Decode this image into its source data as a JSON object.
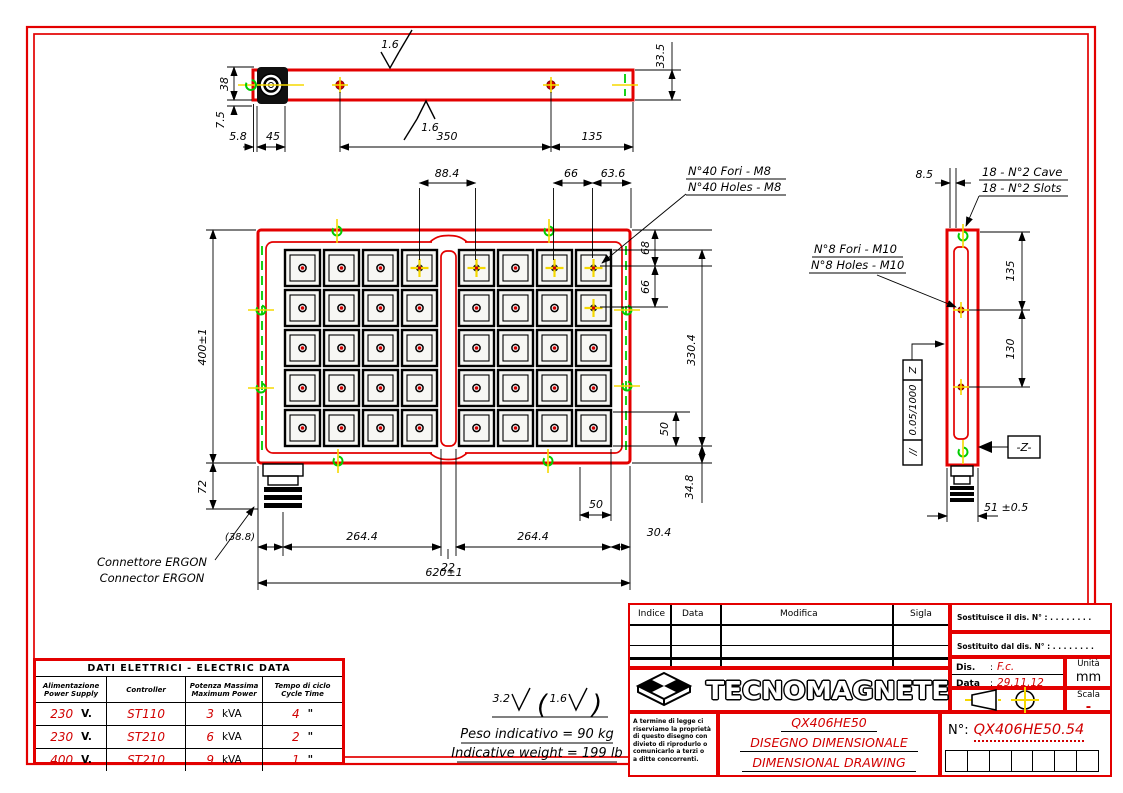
{
  "colors": {
    "line_red": "#e30000",
    "value_red": "#d10000",
    "slot_green": "#00cc00",
    "hole_yellow": "#f5d800"
  },
  "drawing": {
    "top_view": {
      "f_top": "1.6",
      "f_bot": "1.6",
      "d335": "33.5",
      "d38": "38",
      "d75": "7.5",
      "d58": "5.8",
      "d45": "45",
      "d350": "350",
      "d135": "135"
    },
    "front_view": {
      "d884": "88.4",
      "d66t": "66",
      "d636": "63.6",
      "m8_it": "N°40 Fori - M8",
      "m8_en": "N°40 Holes - M8",
      "d68": "68",
      "d66r": "66",
      "d3304": "330.4",
      "d50r": "50",
      "d348": "34.8",
      "d50b": "50",
      "d400": "400±1",
      "d72": "72",
      "d388": "(38.8)",
      "d2644a": "264.4",
      "d22": "22",
      "d2644b": "264.4",
      "d304": "30.4",
      "d620": "620±1",
      "conn_it": "Connettore ERGON",
      "conn_en": "Connector ERGON"
    },
    "side_view": {
      "d85": "8.5",
      "cave_it": "18 - N°2 Cave",
      "cave_en": "18 - N°2 Slots",
      "m10_it": "N°8 Fori - M10",
      "m10_en": "N°8 Holes - M10",
      "d135": "135",
      "d130": "130",
      "fcf_sym": "//",
      "fcf_val": "0.05/1000",
      "fcf_z": "Z",
      "zbox": "-Z-",
      "d51": "51 ±0.5"
    },
    "notes": {
      "ra": "3.2",
      "rb": "1.6",
      "w_it": "Peso indicativo = 90 kg",
      "w_en": "Indicative weight = 199 lb"
    }
  },
  "pole_grid": {
    "rows": 5,
    "cols": 8,
    "tapped": [
      [
        0,
        3
      ],
      [
        0,
        4
      ],
      [
        0,
        6
      ],
      [
        0,
        7
      ],
      [
        1,
        7
      ]
    ]
  },
  "electric_table": {
    "title": "DATI ELETTRICI - ELECTRIC DATA",
    "headers": [
      {
        "l1": "Alimentazione",
        "l2": "Power Supply"
      },
      {
        "l1": "Controller",
        "l2": ""
      },
      {
        "l1": "Potenza Massima",
        "l2": "Maximum Power"
      },
      {
        "l1": "Tempo di ciclo",
        "l2": "Cycle Time"
      }
    ],
    "rows": [
      {
        "v": "230",
        "vu": "V.",
        "ctrl": "ST110",
        "p": "3",
        "pu": "kVA",
        "t": "4",
        "tu": "\""
      },
      {
        "v": "230",
        "vu": "V.",
        "ctrl": "ST210",
        "p": "6",
        "pu": "kVA",
        "t": "2",
        "tu": "\""
      },
      {
        "v": "400",
        "vu": "V.",
        "ctrl": "ST210",
        "p": "9",
        "pu": "kVA",
        "t": "1",
        "tu": "\""
      }
    ]
  },
  "title_block": {
    "rev_headers": [
      "Indice",
      "Data",
      "Modifica",
      "Sigla"
    ],
    "sost1": "Sostituisce il dis. N° :",
    "sost1_dots": ". . . . . . . .",
    "sost2": "Sostituito dal dis. N° :",
    "sost2_dots": ". . . . . . . .",
    "dis_label": "Dis.",
    "dis_sep": ":",
    "dis_value": "F.c.",
    "data_label": "Data",
    "data_sep": ":",
    "data_value": "29.11.12",
    "unit_label": "Unità",
    "unit_value": "mm",
    "scale_label": "Scala",
    "scale_value": "-",
    "company": "TECNOMAGNETE",
    "legal_lines": [
      "A termine di legge ci",
      "riserviamo la proprietà",
      "di questo disegno con",
      "divieto di riprodurlo o",
      "comunicarlo a terzi o",
      "a ditte concorrenti."
    ],
    "product": "QX406HE50",
    "doc_title_it": "DISEGNO DIMENSIONALE",
    "doc_title_en": "DIMENSIONAL DRAWING",
    "number_label": "N°:",
    "number_value": "QX406HE50.54"
  }
}
